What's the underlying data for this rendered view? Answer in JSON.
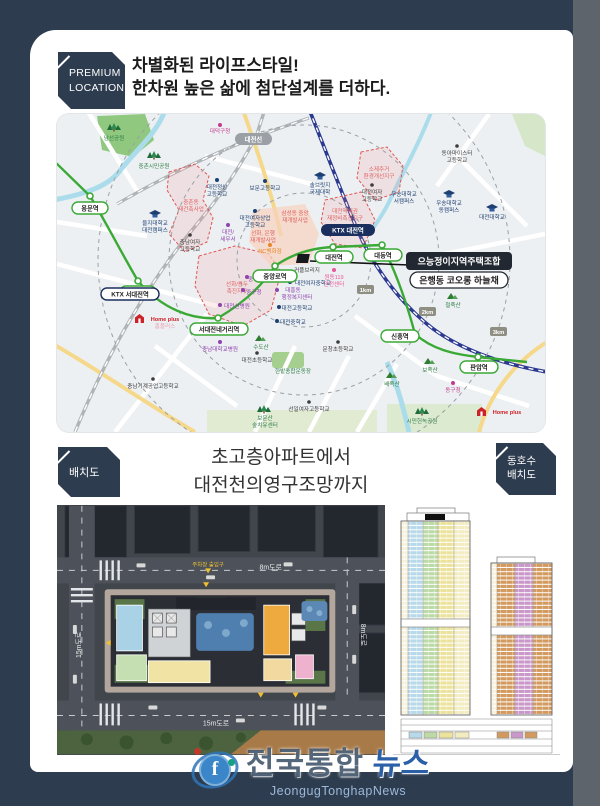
{
  "header": {
    "badge_line1": "PREMIUM",
    "badge_line2": "LOCATION",
    "headline_line1": "차별화된 라이프스타일!",
    "headline_line2": "한차원 높은 삶에 첨단설계를 더하다."
  },
  "map": {
    "rail_label": "대전선",
    "km": [
      "1km",
      "2km",
      "3km"
    ],
    "stations": [
      "용문역",
      "오룡역",
      "서대전네거리역",
      "중앙로역",
      "대전역",
      "대동역",
      "신흥역",
      "판암역"
    ],
    "ktx": [
      "KTX 서대전역",
      "KTX 대전역"
    ],
    "callout": {
      "line1": "으능정이지역주택조합",
      "line2": "은행동 코오롱 하늘채"
    },
    "site_label": "커플브리지",
    "zones": [
      {
        "l1": "중촌동",
        "l2": "재건축사업"
      },
      {
        "l1": "선화/용두",
        "l2": "촉진지구"
      },
      {
        "l1": "소제주거",
        "l2": "환경개선지구"
      },
      {
        "l1": "대전역세권",
        "l2": "재정비촉진지구"
      },
      {
        "l1": "삼성동 중앙",
        "l2": "재개발사업"
      },
      {
        "l1": "선화, 은행",
        "l2": "재개발사업"
      }
    ],
    "landmarks": [
      {
        "l1": "대덕구청"
      },
      {
        "l1": "솔브릿지",
        "l2": "국제대학"
      },
      {
        "l1": "을지대학교",
        "l2": "대전캠퍼스"
      },
      {
        "l1": "대전정상",
        "l2": "고등학교"
      },
      {
        "l1": "보문고등학교"
      },
      {
        "l1": "충남여자",
        "l2": "고등학교"
      },
      {
        "l1": "대전/",
        "l2": "세무서"
      },
      {
        "l1": "대전여자상업",
        "l2": "고등학교"
      },
      {
        "l1": "NC백화점"
      },
      {
        "l1": "중부경찰서"
      },
      {
        "l1": "중구청"
      },
      {
        "l1": "대흥동",
        "l2": "행정복지센터"
      },
      {
        "l1": "대전고등학교"
      },
      {
        "l1": "대전중학교"
      },
      {
        "l1": "대전여자중학교"
      },
      {
        "l1": "대전선병원"
      },
      {
        "l1": "원동119",
        "l2": "안전센터"
      },
      {
        "l1": "대전여자",
        "l2": "고등학교"
      },
      {
        "l1": "우송대학교",
        "l2": "서캠퍼스"
      },
      {
        "l1": "동아마이스터",
        "l2": "고등학교"
      },
      {
        "l1": "우송대학교",
        "l2": "동캠퍼스"
      },
      {
        "l1": "대전대학교"
      },
      {
        "l1": "충남대학교병원"
      },
      {
        "l1": "대전초등학교"
      },
      {
        "l1": "충남기계공업고등학교"
      },
      {
        "l1": "문창초등학교"
      },
      {
        "l1": "선일여자고등학교"
      },
      {
        "l1": "동구청"
      }
    ],
    "parks": [
      {
        "l1": "남선공원"
      },
      {
        "l1": "중촌시민공원"
      },
      {
        "l1": "한밭종합운동장"
      },
      {
        "l1": "보문산",
        "l2": "숲치유센터"
      },
      {
        "l1": "시민헌녹공원"
      }
    ],
    "mountains": [
      "수도산",
      "철죽산",
      "보족산",
      "배족산"
    ],
    "homeplus": {
      "label": "Home plus",
      "sub": "홈플러스"
    },
    "colors": {
      "line1_green": "#3aa935",
      "callout_bg": "#222831",
      "zone_red": "#e05555"
    }
  },
  "section2": {
    "badge": "배치도",
    "heading_line1": "초고층아파트에서",
    "heading_line2": "대전천의영구조망까지",
    "badge2_line1": "동호수",
    "badge2_line2": "배치도"
  },
  "siteplan": {
    "road_top": "8m도로",
    "road_left": "15m도로",
    "road_right": "8m도로",
    "road_bottom": "15m도로",
    "gate_label": "주차장 출입구"
  },
  "unit_chart": {
    "left_tower_colors": [
      "#b8d9ea",
      "#bcd9a6",
      "#ece29c",
      "#f3ecc0"
    ],
    "right_tower_colors": [
      "#d39a5f",
      "#c997c9",
      "#d39a5f"
    ]
  },
  "watermark": {
    "title_part1": "전국통합",
    "title_part2": "뉴스",
    "subtitle": "JeongugTonghapNews"
  }
}
